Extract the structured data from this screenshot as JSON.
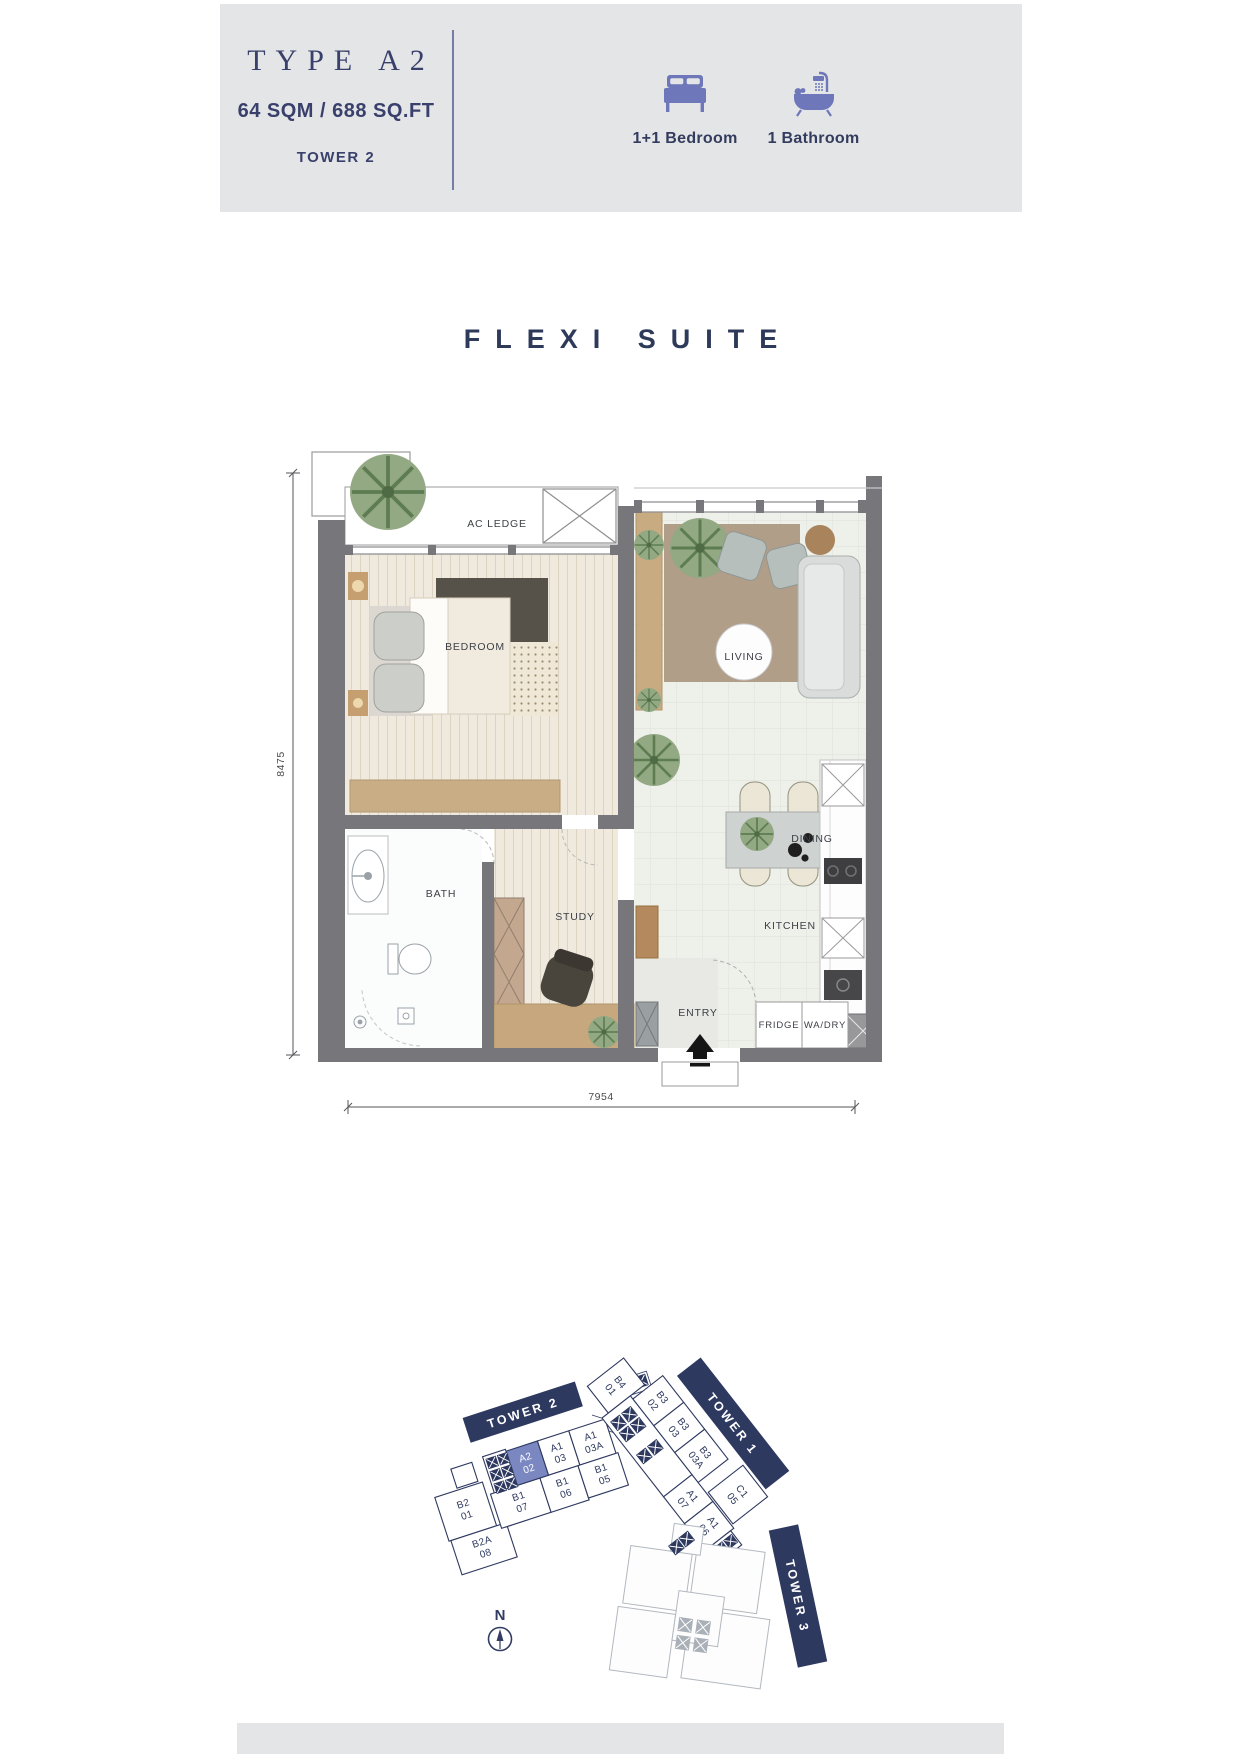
{
  "header": {
    "type_label": "TYPE A2",
    "area": "64 SQM / 688 SQ.FT",
    "tower": "TOWER 2",
    "features": [
      {
        "icon": "bed-icon",
        "label": "1+1 Bedroom"
      },
      {
        "icon": "bathtub-icon",
        "label": "1 Bathroom"
      }
    ]
  },
  "plan": {
    "title": "FLEXI SUITE",
    "labels": {
      "ac_ledge": "AC LEDGE",
      "bedroom": "BEDROOM",
      "living": "LIVING",
      "bath": "BATH",
      "study": "STUDY",
      "dining": "DINING",
      "kitchen": "KITCHEN",
      "entry": "ENTRY",
      "fridge": "FRIDGE",
      "wa_dry": "WA/DRY"
    },
    "dims": {
      "height": "8475",
      "width": "7954"
    }
  },
  "key_plan": {
    "banners": {
      "tower2": "TOWER 2",
      "tower1": "TOWER 1",
      "tower3": "TOWER 3"
    },
    "north": "N",
    "highlight_unit": {
      "l1": "A2",
      "l2": "02"
    },
    "tower2_top": [
      {
        "l1": "A1",
        "l2": "03"
      },
      {
        "l1": "A1",
        "l2": "03A"
      }
    ],
    "tower2_bottom": [
      {
        "l1": "B1",
        "l2": "07"
      },
      {
        "l1": "B1",
        "l2": "06"
      },
      {
        "l1": "B1",
        "l2": "05"
      },
      {
        "l1": "B2",
        "l2": "01"
      },
      {
        "l1": "B2A",
        "l2": "08"
      }
    ],
    "tower1_left": [
      {
        "l1": "B4",
        "l2": "01"
      },
      {
        "l1": "A1",
        "l2": "07"
      },
      {
        "l1": "A1",
        "l2": "06"
      }
    ],
    "tower1_right": [
      {
        "l1": "B3",
        "l2": "02"
      },
      {
        "l1": "B3",
        "l2": "03"
      },
      {
        "l1": "B3",
        "l2": "03A"
      },
      {
        "l1": "C1",
        "l2": "05"
      }
    ]
  },
  "colors": {
    "header_bg": "#e4e5e7",
    "navy": "#323c63",
    "icon_accent": "#6d77b9",
    "unit_highlight": "#7b87c1",
    "wall_gray": "#77777b"
  }
}
